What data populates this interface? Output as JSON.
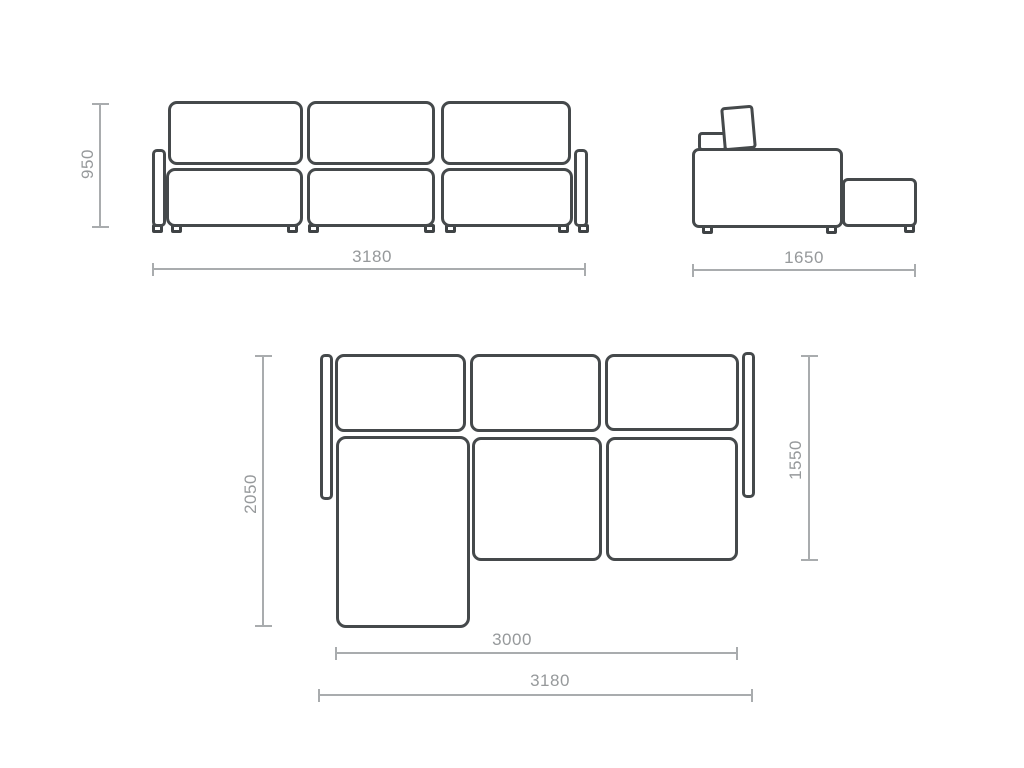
{
  "colors": {
    "outline": "#45494b",
    "dimension_line": "#a9acae",
    "dimension_text": "#96999b",
    "module_fill": "#ffffff",
    "background": "#ffffff"
  },
  "views": {
    "front": {
      "name": "front-view",
      "height": "950",
      "width": "3180"
    },
    "side": {
      "name": "side-view",
      "depth": "1650"
    },
    "top": {
      "name": "top-plan-view",
      "depth_with_chaise": "2050",
      "depth_without_chaise": "1550",
      "seat_width": "3000",
      "overall_width": "3180"
    }
  }
}
